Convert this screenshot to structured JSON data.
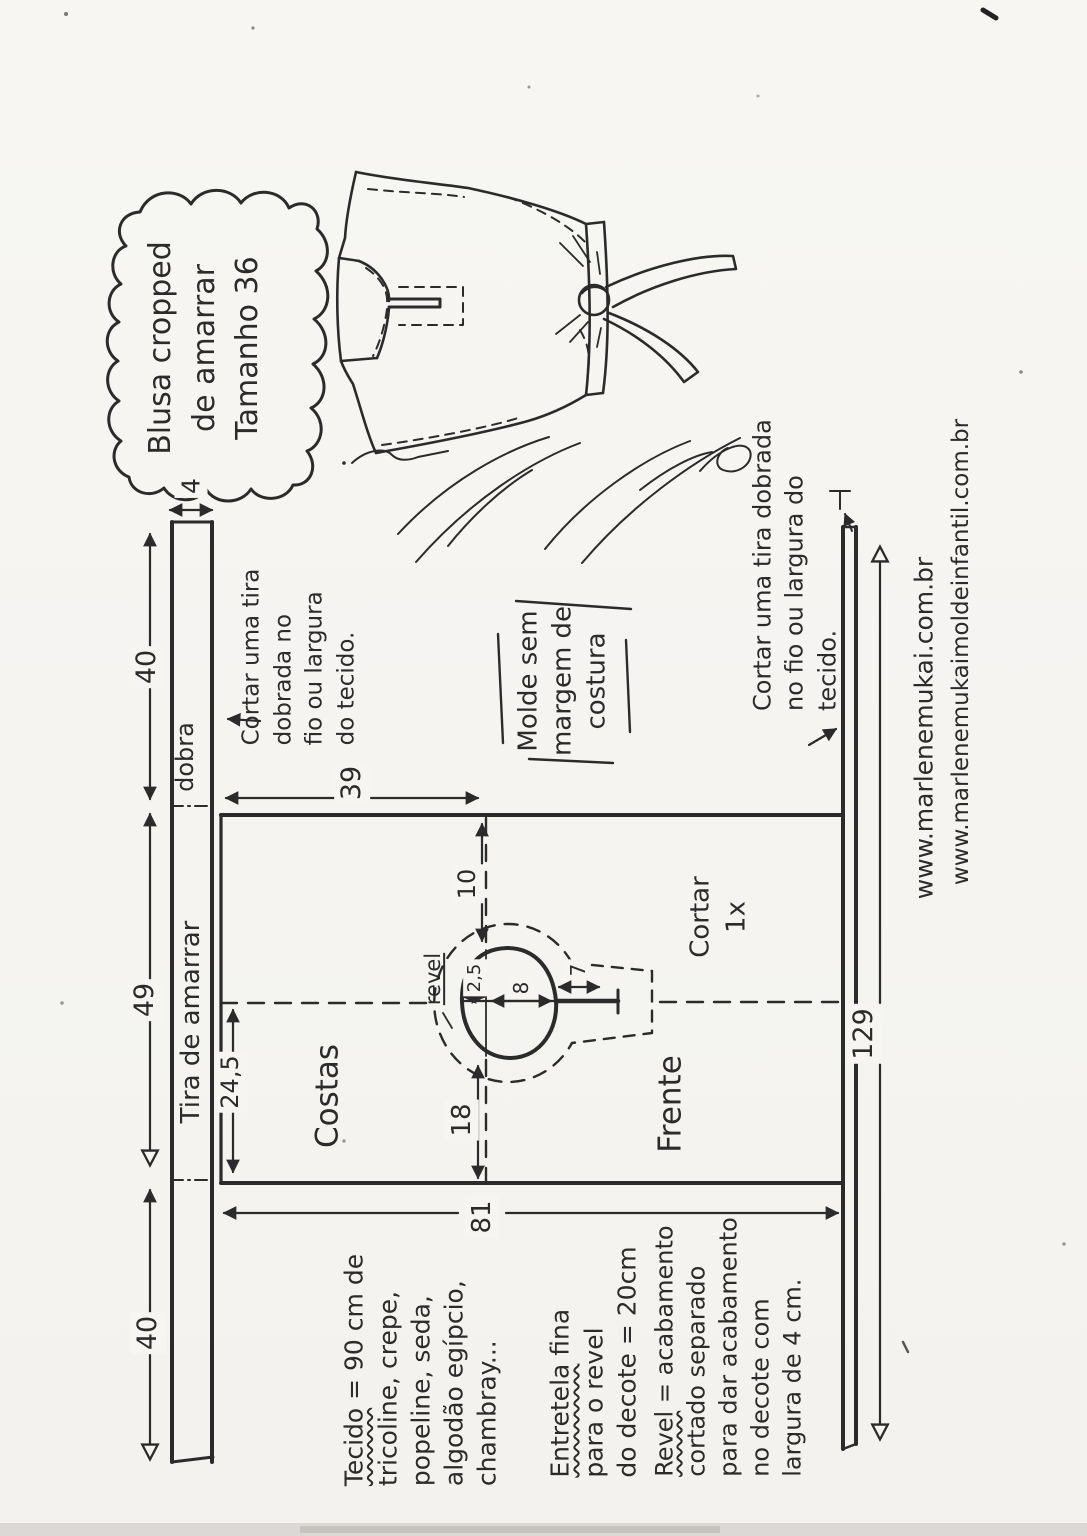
{
  "title_bubble": {
    "text": "Blusa cropped\nde amarrar\nTamanho 36"
  },
  "pattern_labels": {
    "tie_strip": "Tira de amarrar",
    "fold": "dobra",
    "back": "Costas",
    "front": "Frente",
    "cut_count": "Cortar\n1x",
    "facing": "revel",
    "no_seam": "Molde sem\nmargem de\ncostura",
    "cut_strip_left": "Cortar uma tira\ndobrada no\nfio ou largura\ndo tecido.",
    "cut_strip_right": "Cortar uma tira dobrada\nno fio ou largura do tecido."
  },
  "dimensions": {
    "strip_width": "4",
    "strip_seg_top": "40",
    "strip_seg_mid": "49",
    "strip_seg_bottom": "40",
    "back_fold_depth": "24,5",
    "back_top_width": "39",
    "neck_drop": "10",
    "front_neck_depth": "18",
    "body_width": "81",
    "side_length": "129",
    "neck_left_offset": "2,5",
    "neck_opening": "8",
    "slit_length": "7"
  },
  "notes": {
    "fabric_head": "Tecido",
    "fabric_rest": " = 90 cm de\ntricoline, crepe,\npopeline, seda,\nalgodão egípcio,\nchambray...",
    "interfacing_head": "Entretela",
    "interfacing_rest": " fina\npara o revel\ndo decote = 20cm",
    "facing_head": "Revel",
    "facing_rest": " = acabamento\ncortado separado\npara dar acabamento\nno decote com\nlargura de 4 cm."
  },
  "footer": {
    "site1": "www.marlenemukai.com.br",
    "site2": "www.marlenemukaimoldeinfantil.com.br"
  },
  "colors": {
    "ink": "#2b2b2b",
    "paper": "#f6f5f2"
  }
}
